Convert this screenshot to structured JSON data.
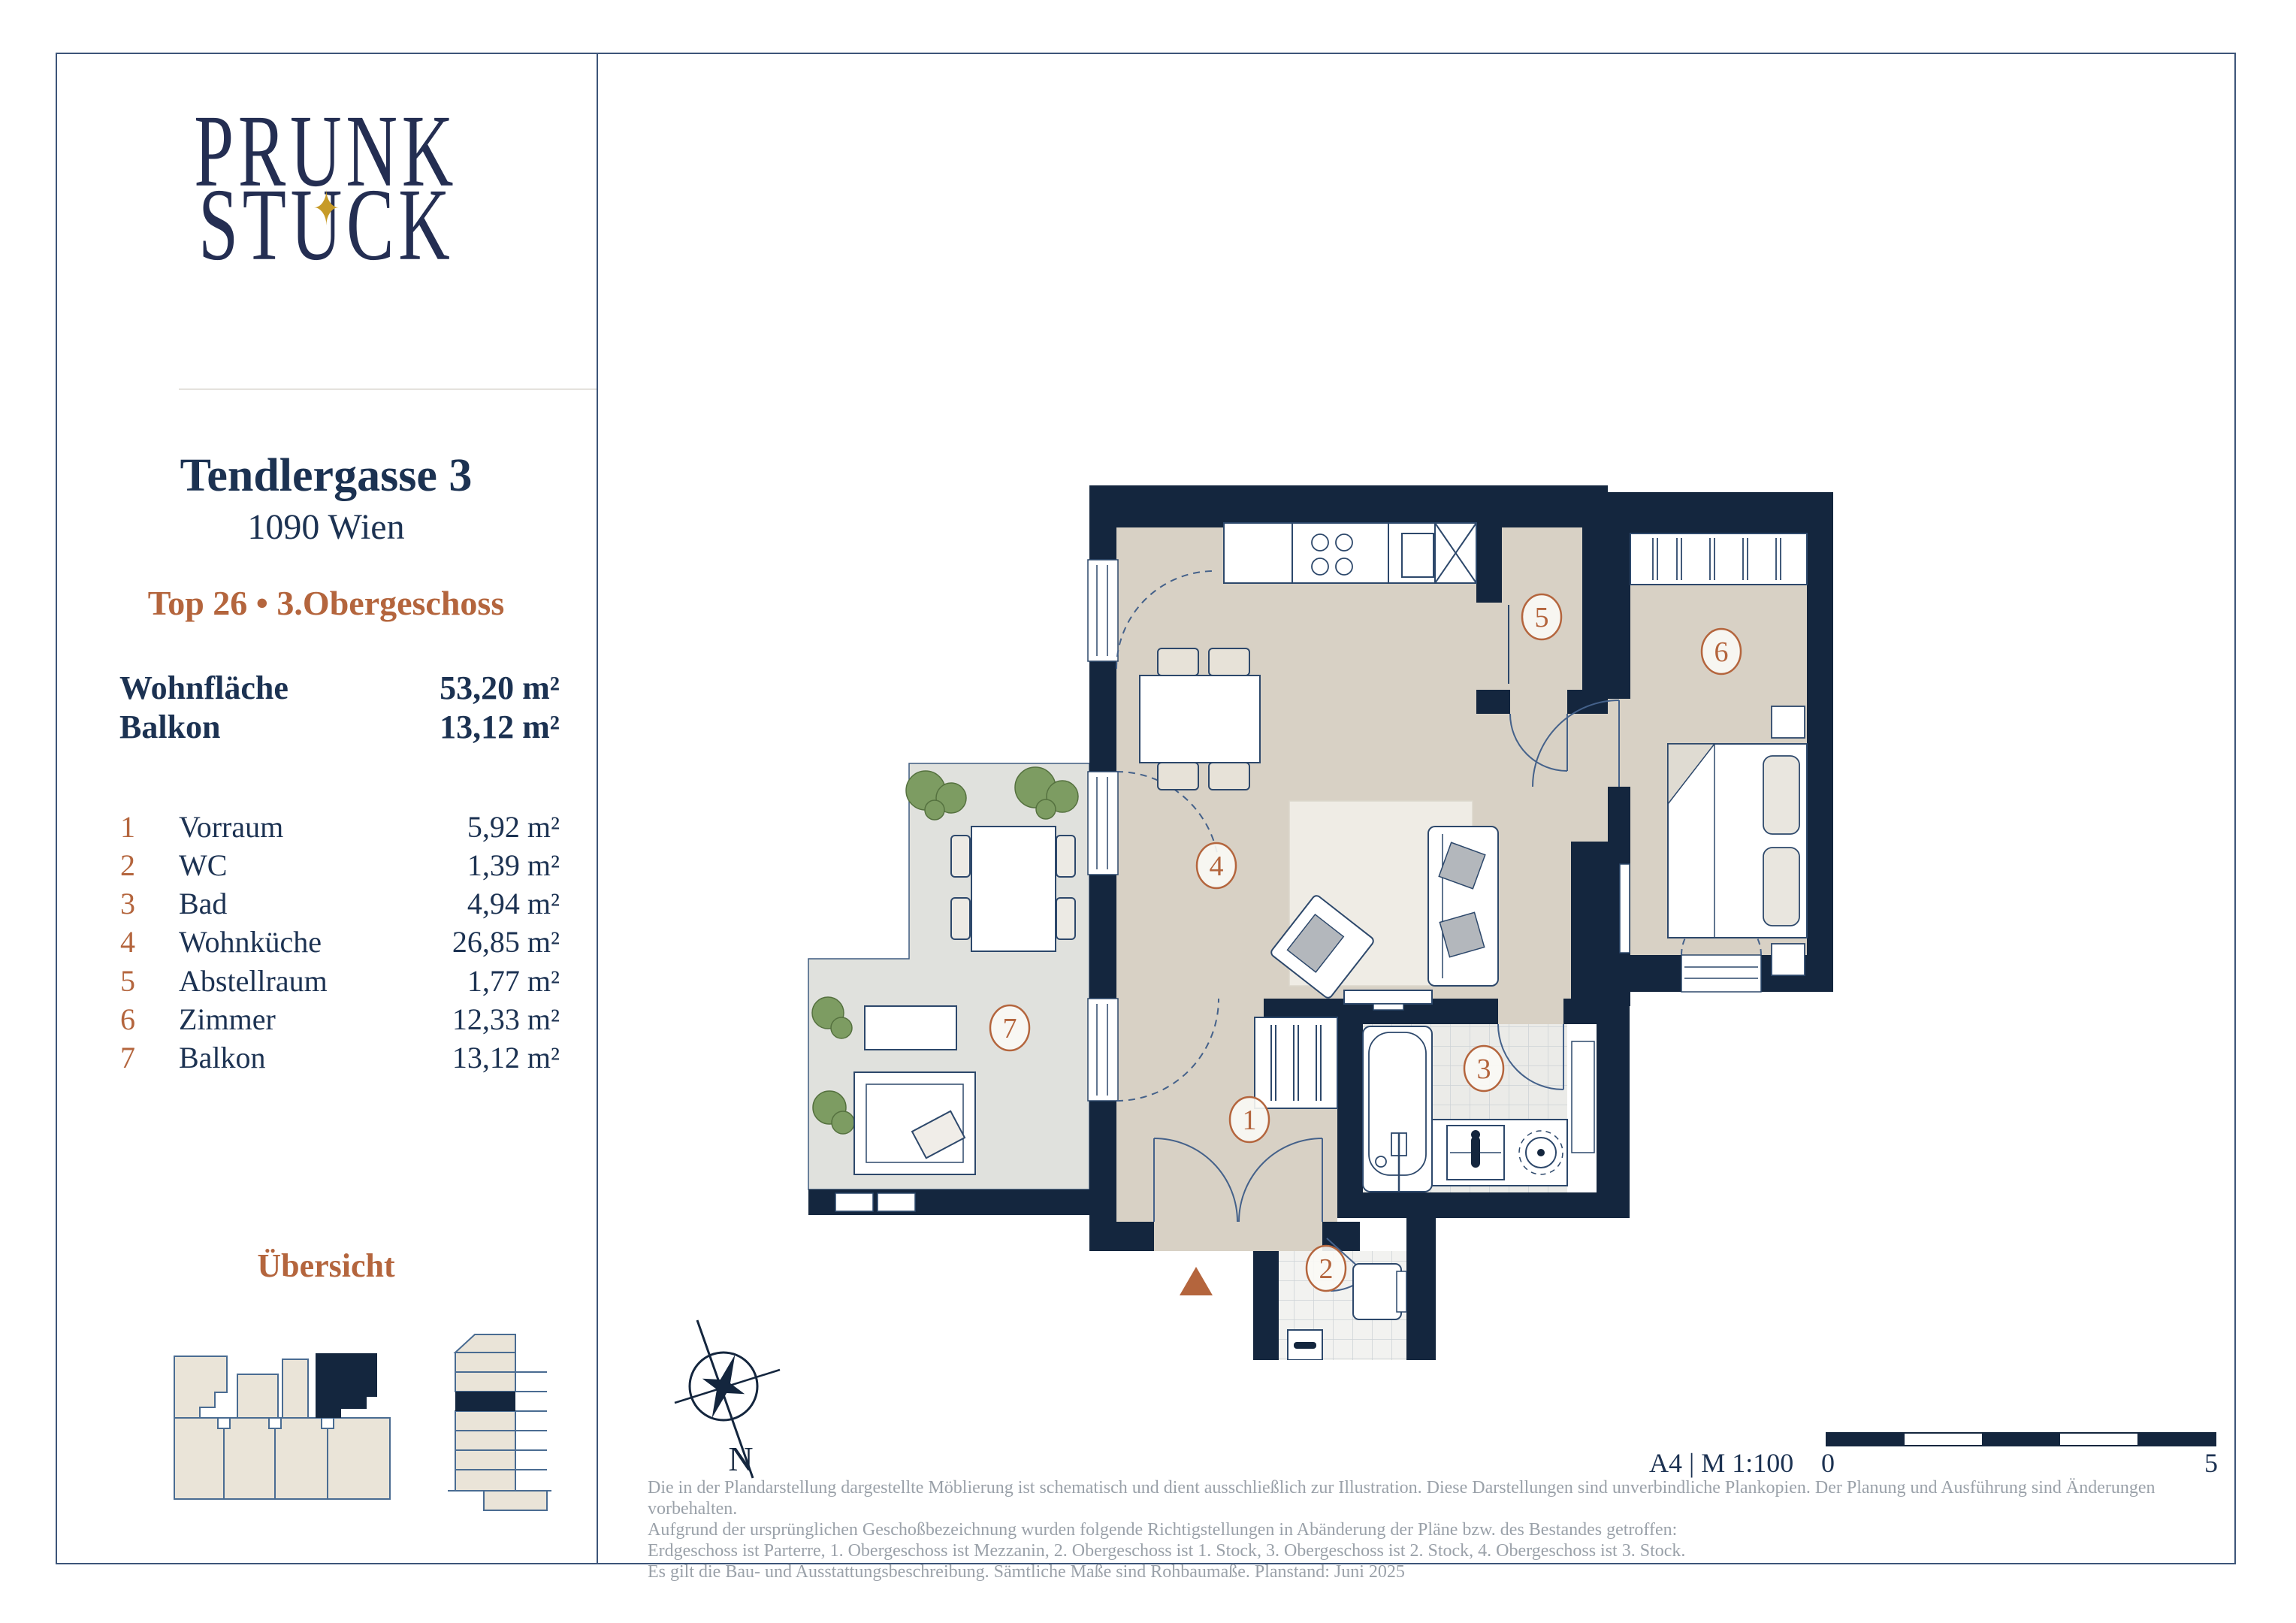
{
  "brand": {
    "line1": "PRUNK",
    "line2_left": "ST",
    "line2_u": "U",
    "line2_right": "CK",
    "star": "✦"
  },
  "sidebar": {
    "address": "Tendlergasse 3",
    "city": "1090 Wien",
    "unit_line": "Top 26 • 3.Obergeschoss",
    "summary": [
      {
        "label": "Wohnfläche",
        "value": "53,20 m²"
      },
      {
        "label": "Balkon",
        "value": "13,12 m²"
      }
    ],
    "rooms": [
      {
        "num": "1",
        "name": "Vorraum",
        "area": "5,92 m²"
      },
      {
        "num": "2",
        "name": "WC",
        "area": "1,39 m²"
      },
      {
        "num": "3",
        "name": "Bad",
        "area": "4,94 m²"
      },
      {
        "num": "4",
        "name": "Wohnküche",
        "area": "26,85 m²"
      },
      {
        "num": "5",
        "name": "Abstellraum",
        "area": "1,77 m²"
      },
      {
        "num": "6",
        "name": "Zimmer",
        "area": "12,33 m²"
      },
      {
        "num": "7",
        "name": "Balkon",
        "area": "13,12 m²"
      }
    ],
    "overview_title": "Übersicht"
  },
  "plan": {
    "compass_label": "N"
  },
  "footer": {
    "format_scale": "A4 | M 1:100",
    "scale_start": "0",
    "scale_end": "5",
    "disclaimer": [
      "Die in der Plandarstellung dargestellte Möblierung ist schematisch und dient ausschließlich zur Illustration. Diese Darstellungen sind unverbindliche Plankopien. Der Planung und Ausführung sind Änderungen vorbehalten.",
      "Aufgrund der ursprünglichen Geschoßbezeichnung wurden folgende Richtigstellungen in Abänderung der Pläne bzw. des Bestandes getroffen:",
      "Erdgeschoss ist Parterre, 1. Obergeschoss ist Mezzanin, 2. Obergeschoss ist 1. Stock, 3. Obergeschoss ist 2. Stock, 4. Obergeschoss ist 3. Stock.",
      "Es gilt die Bau- und Ausstattungsbeschreibung. Sämtliche Maße sind Rohbaumaße. Planstand: Juni 2025"
    ]
  },
  "colors": {
    "navy": "#14263e",
    "terracotta": "#b4653d",
    "gold": "#c79b28",
    "floor": "#d8d1c5",
    "balcony": "#e0e1dd"
  }
}
